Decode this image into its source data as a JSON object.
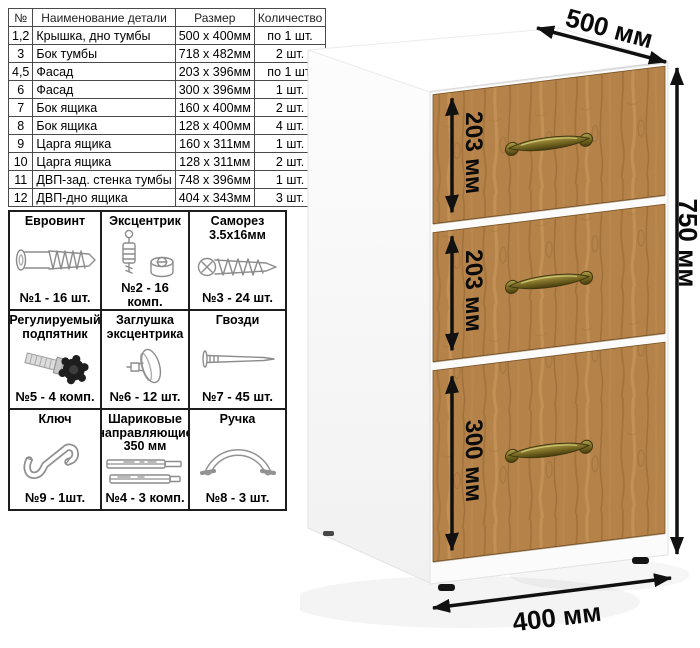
{
  "parts_table": {
    "headers": {
      "num": "№",
      "name": "Наименование детали",
      "size": "Размер",
      "qty": "Количество"
    },
    "rows": [
      {
        "num": "1,2",
        "name": "Крышка, дно тумбы",
        "size": "500 x 400мм",
        "qty": "по 1 шт."
      },
      {
        "num": "3",
        "name": "Бок тумбы",
        "size": "718 x 482мм",
        "qty": "2 шт."
      },
      {
        "num": "4,5",
        "name": "Фасад",
        "size": "203 x 396мм",
        "qty": "по 1 шт."
      },
      {
        "num": "6",
        "name": "Фасад",
        "size": "300 x 396мм",
        "qty": "1 шт."
      },
      {
        "num": "7",
        "name": "Бок ящика",
        "size": "160 x 400мм",
        "qty": "2 шт."
      },
      {
        "num": "8",
        "name": "Бок ящика",
        "size": "128 x 400мм",
        "qty": "4 шт."
      },
      {
        "num": "9",
        "name": "Царга ящика",
        "size": "160 x 311мм",
        "qty": "1 шт."
      },
      {
        "num": "10",
        "name": "Царга ящика",
        "size": "128 x 311мм",
        "qty": "2 шт."
      },
      {
        "num": "11",
        "name": "ДВП-зад. стенка тумбы",
        "size": "748 x 396мм",
        "qty": "1 шт."
      },
      {
        "num": "12",
        "name": "ДВП-дно ящика",
        "size": "404 x 343мм",
        "qty": "3 шт."
      }
    ]
  },
  "hardware": {
    "cells": [
      {
        "title": "Евровинт",
        "icon": "euro-screw-icon",
        "qty": "№1 - 16 шт."
      },
      {
        "title": "Эксцентрик",
        "icon": "eccentric-cam-icon",
        "qty": "№2 - 16 комп."
      },
      {
        "title": "Саморез 3.5x16мм",
        "icon": "self-tapping-screw-icon",
        "qty": "№3 - 24 шт."
      },
      {
        "title": "Регулируемый подпятник",
        "icon": "adjustable-foot-icon",
        "qty": "№5 - 4 комп."
      },
      {
        "title": "Заглушка эксцентрика",
        "icon": "cam-cover-icon",
        "qty": "№6 - 12 шт."
      },
      {
        "title": "Гвозди",
        "icon": "nail-icon",
        "qty": "№7 - 45 шт."
      },
      {
        "title": "Ключ",
        "icon": "hex-key-icon",
        "qty": "№9 - 1шт."
      },
      {
        "title": "Шариковые направляющие 350 мм",
        "icon": "ball-slides-icon",
        "qty": "№4 - 3 комп."
      },
      {
        "title": "Ручка",
        "icon": "drawer-handle-icon",
        "qty": "№8 - 3 шт."
      }
    ]
  },
  "cabinet": {
    "dims": {
      "depth": "500 мм",
      "height": "750 мм",
      "width": "400 мм",
      "drawer1": "203 мм",
      "drawer2": "203 мм",
      "drawer3": "300 мм"
    },
    "colors": {
      "wood": "#b5834a",
      "wood_dark": "#8f6633",
      "handle_brass": "#7c6d24",
      "arrow": "#111111",
      "carcass": "#ffffff"
    }
  }
}
